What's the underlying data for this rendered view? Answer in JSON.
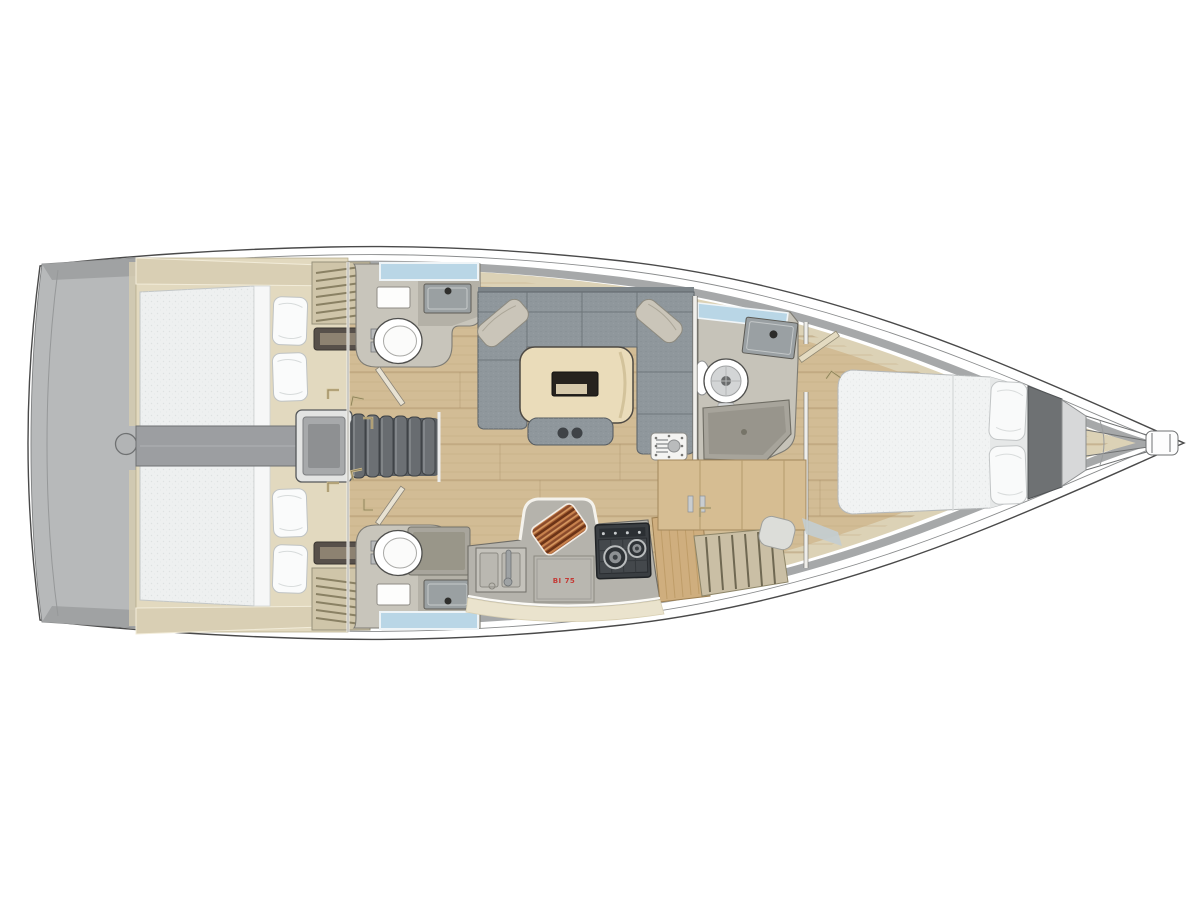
{
  "diagram": {
    "type": "sailing-yacht-interior-floor-plan",
    "orientation": "bow-right-stern-left",
    "labels": {
      "galley_panel": "BI 75"
    },
    "palette": {
      "background": "#ffffff",
      "hull_outline": "#4a4a4a",
      "deck_rim_gray": "#a6a8a9",
      "liner_beige": "#dcd2b6",
      "floor_oak": "#d2bc95",
      "stern_platform_gray": "#b7b9ba",
      "mattress_white": "#f0f2f2",
      "sofa_gray": "#8f979c",
      "table_wood": "#eadcba",
      "stairs_gray": "#686c70",
      "window_blue": "#b9d6e6",
      "stove_dark": "#3a3e42",
      "cutting_board_brown": "#8a4a2a",
      "label_red": "#c43a35"
    },
    "rooms": [
      {
        "name": "swim-platform",
        "features": [
          "transom-hatch"
        ]
      },
      {
        "name": "aft-cabin-port",
        "features": [
          "double-bed",
          "two-pillows",
          "slatted-locker",
          "vent"
        ]
      },
      {
        "name": "aft-cabin-starboard",
        "features": [
          "double-bed",
          "two-pillows",
          "slatted-locker",
          "vent"
        ]
      },
      {
        "name": "companionway",
        "features": [
          "engine-box",
          "six-steps"
        ]
      },
      {
        "name": "aft-head-port",
        "features": [
          "toilet",
          "sink",
          "mirror",
          "window"
        ]
      },
      {
        "name": "aft-head-starboard",
        "features": [
          "toilet",
          "sink",
          "shower",
          "mirror",
          "window"
        ]
      },
      {
        "name": "salon",
        "features": [
          "u-sofa",
          "two-cushions",
          "dining-table",
          "bench",
          "mast-step-plate"
        ]
      },
      {
        "name": "galley",
        "features": [
          "double-sink",
          "faucet",
          "two-burner-stove",
          "cutting-board",
          "labelled-panel"
        ]
      },
      {
        "name": "forward-head",
        "features": [
          "toilet",
          "sink",
          "shower",
          "window",
          "door"
        ]
      },
      {
        "name": "forward-cabin",
        "features": [
          "island-bed",
          "two-pillows"
        ]
      },
      {
        "name": "bow",
        "features": [
          "anchor-locker",
          "bowsprit"
        ]
      }
    ],
    "companionway_steps": 6
  }
}
